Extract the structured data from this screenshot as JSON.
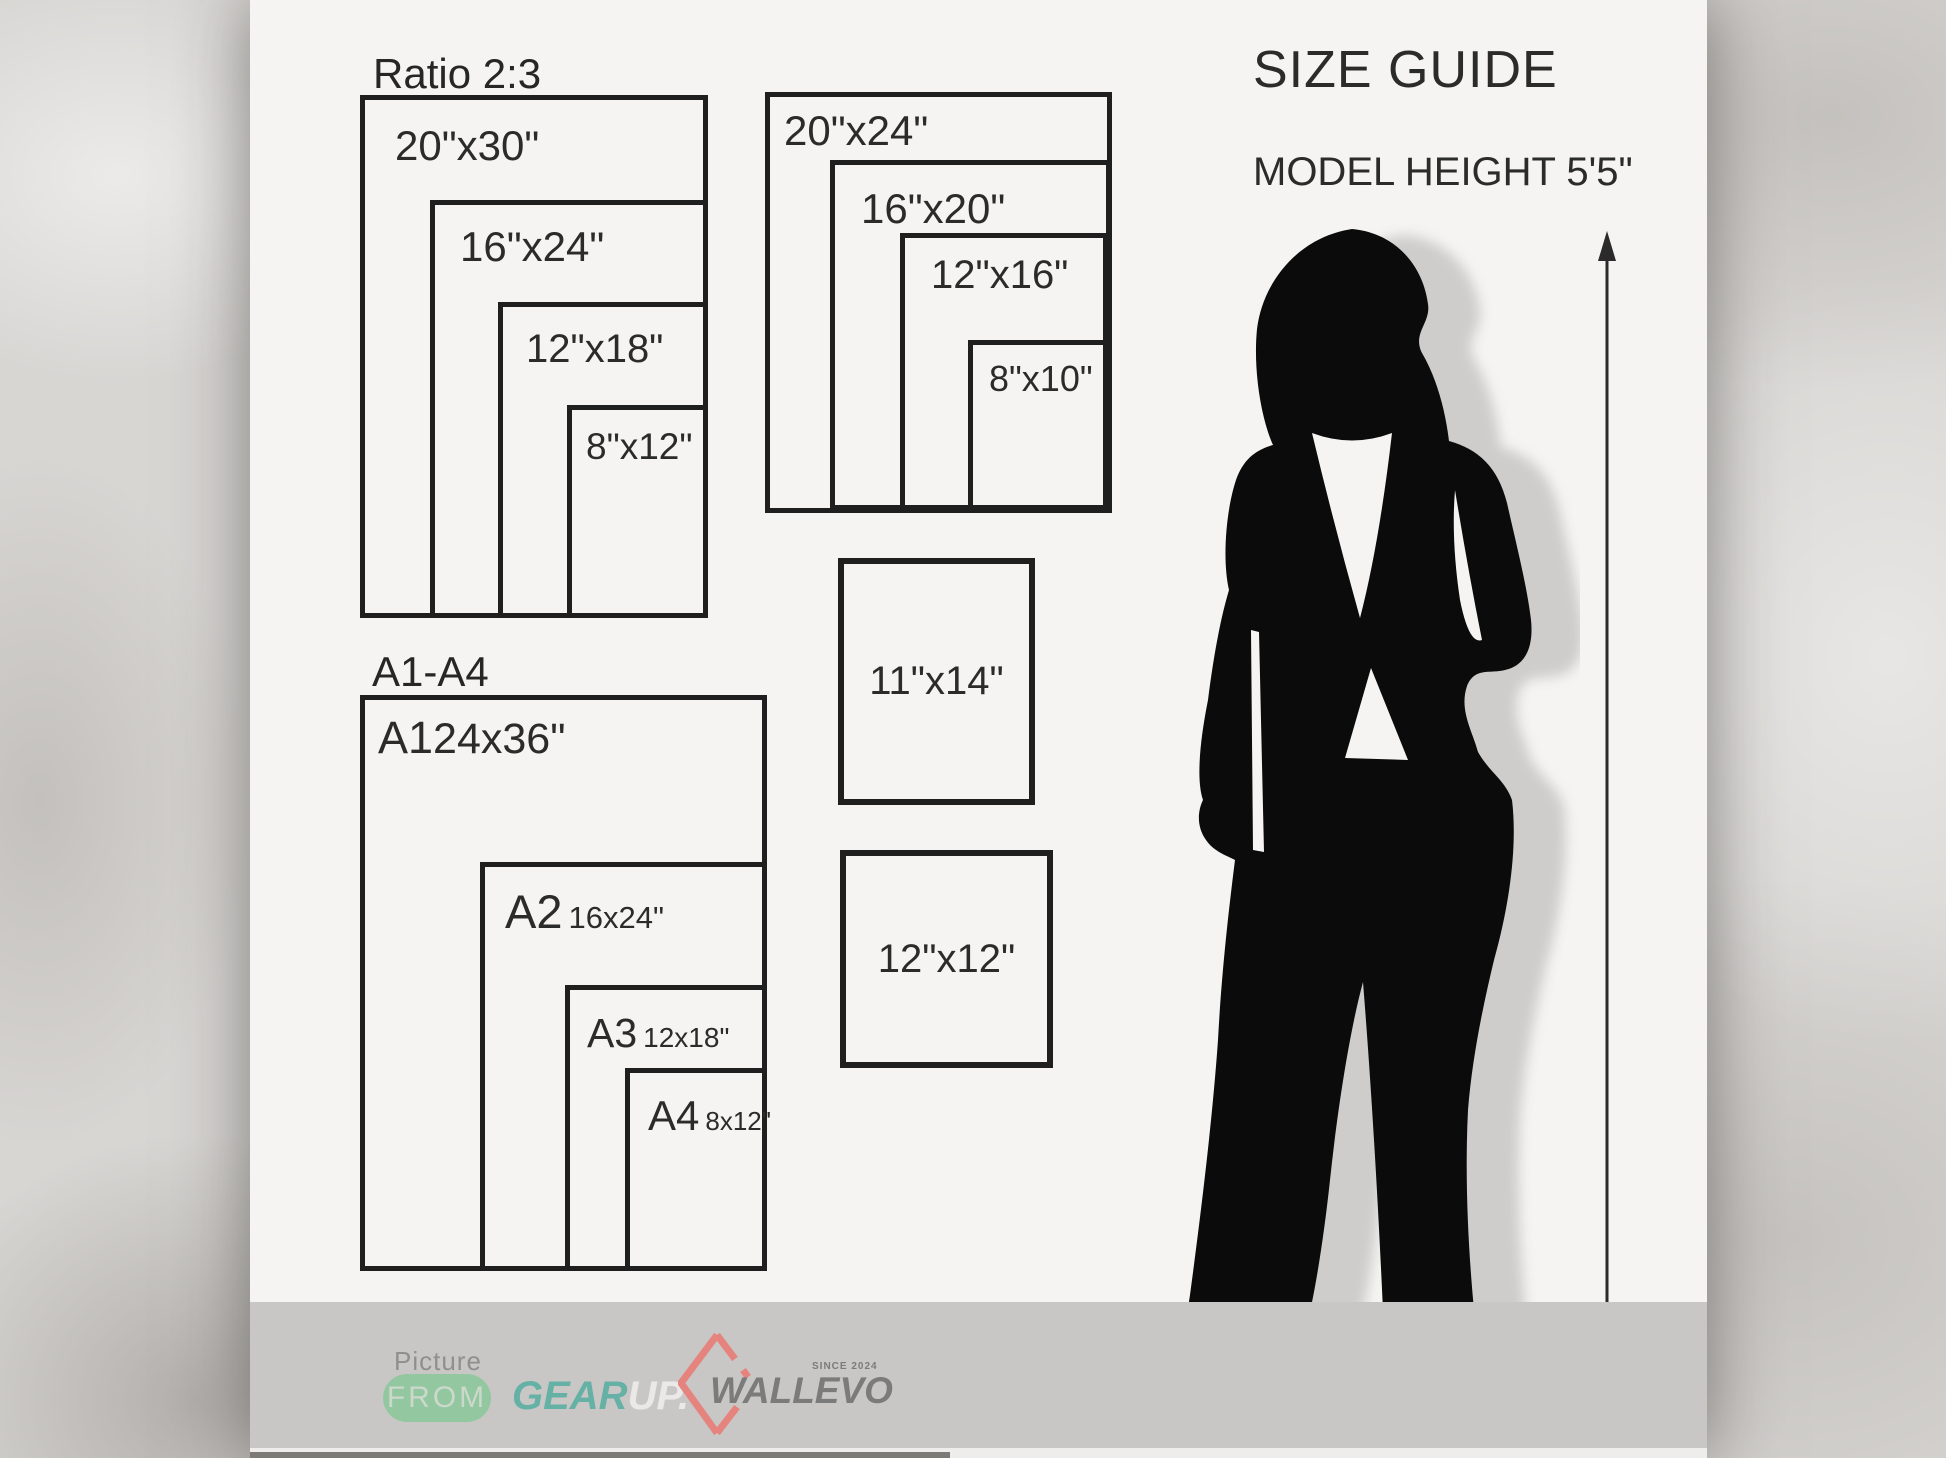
{
  "title": "SIZE GUIDE",
  "subtitle": "MODEL HEIGHT 5'5\"",
  "ratio_group": {
    "label": "Ratio 2:3",
    "sizes": [
      "20\"x30\"",
      "16\"x24\"",
      "12\"x18\"",
      "8\"x12\""
    ]
  },
  "standard_group": {
    "sizes": [
      "20\"x24\"",
      "16\"x20\"",
      "12\"x16\"",
      "8\"x10\""
    ]
  },
  "a_group": {
    "label": "A1-A4",
    "items": [
      {
        "code": "A1",
        "size": "24x36\""
      },
      {
        "code": "A2",
        "size": "16x24\""
      },
      {
        "code": "A3",
        "size": "12x18\""
      },
      {
        "code": "A4",
        "size": "8x12\""
      }
    ]
  },
  "single_boxes": [
    "11\"x14\"",
    "12\"x12\""
  ],
  "footer": {
    "picture": "Picture",
    "from": "FROM",
    "gear": "GEAR",
    "up": "UP.",
    "brand": "WALLEVO",
    "since": "SINCE 2024"
  },
  "colors": {
    "accent_green": "#92c7a0",
    "accent_teal": "#66b1a5",
    "accent_salmon": "#e5837e",
    "panel": "#f5f4f2",
    "footer_bar": "#c9c7c5",
    "ink": "#1f1f1f",
    "silhouette": "#0b0b0b"
  }
}
